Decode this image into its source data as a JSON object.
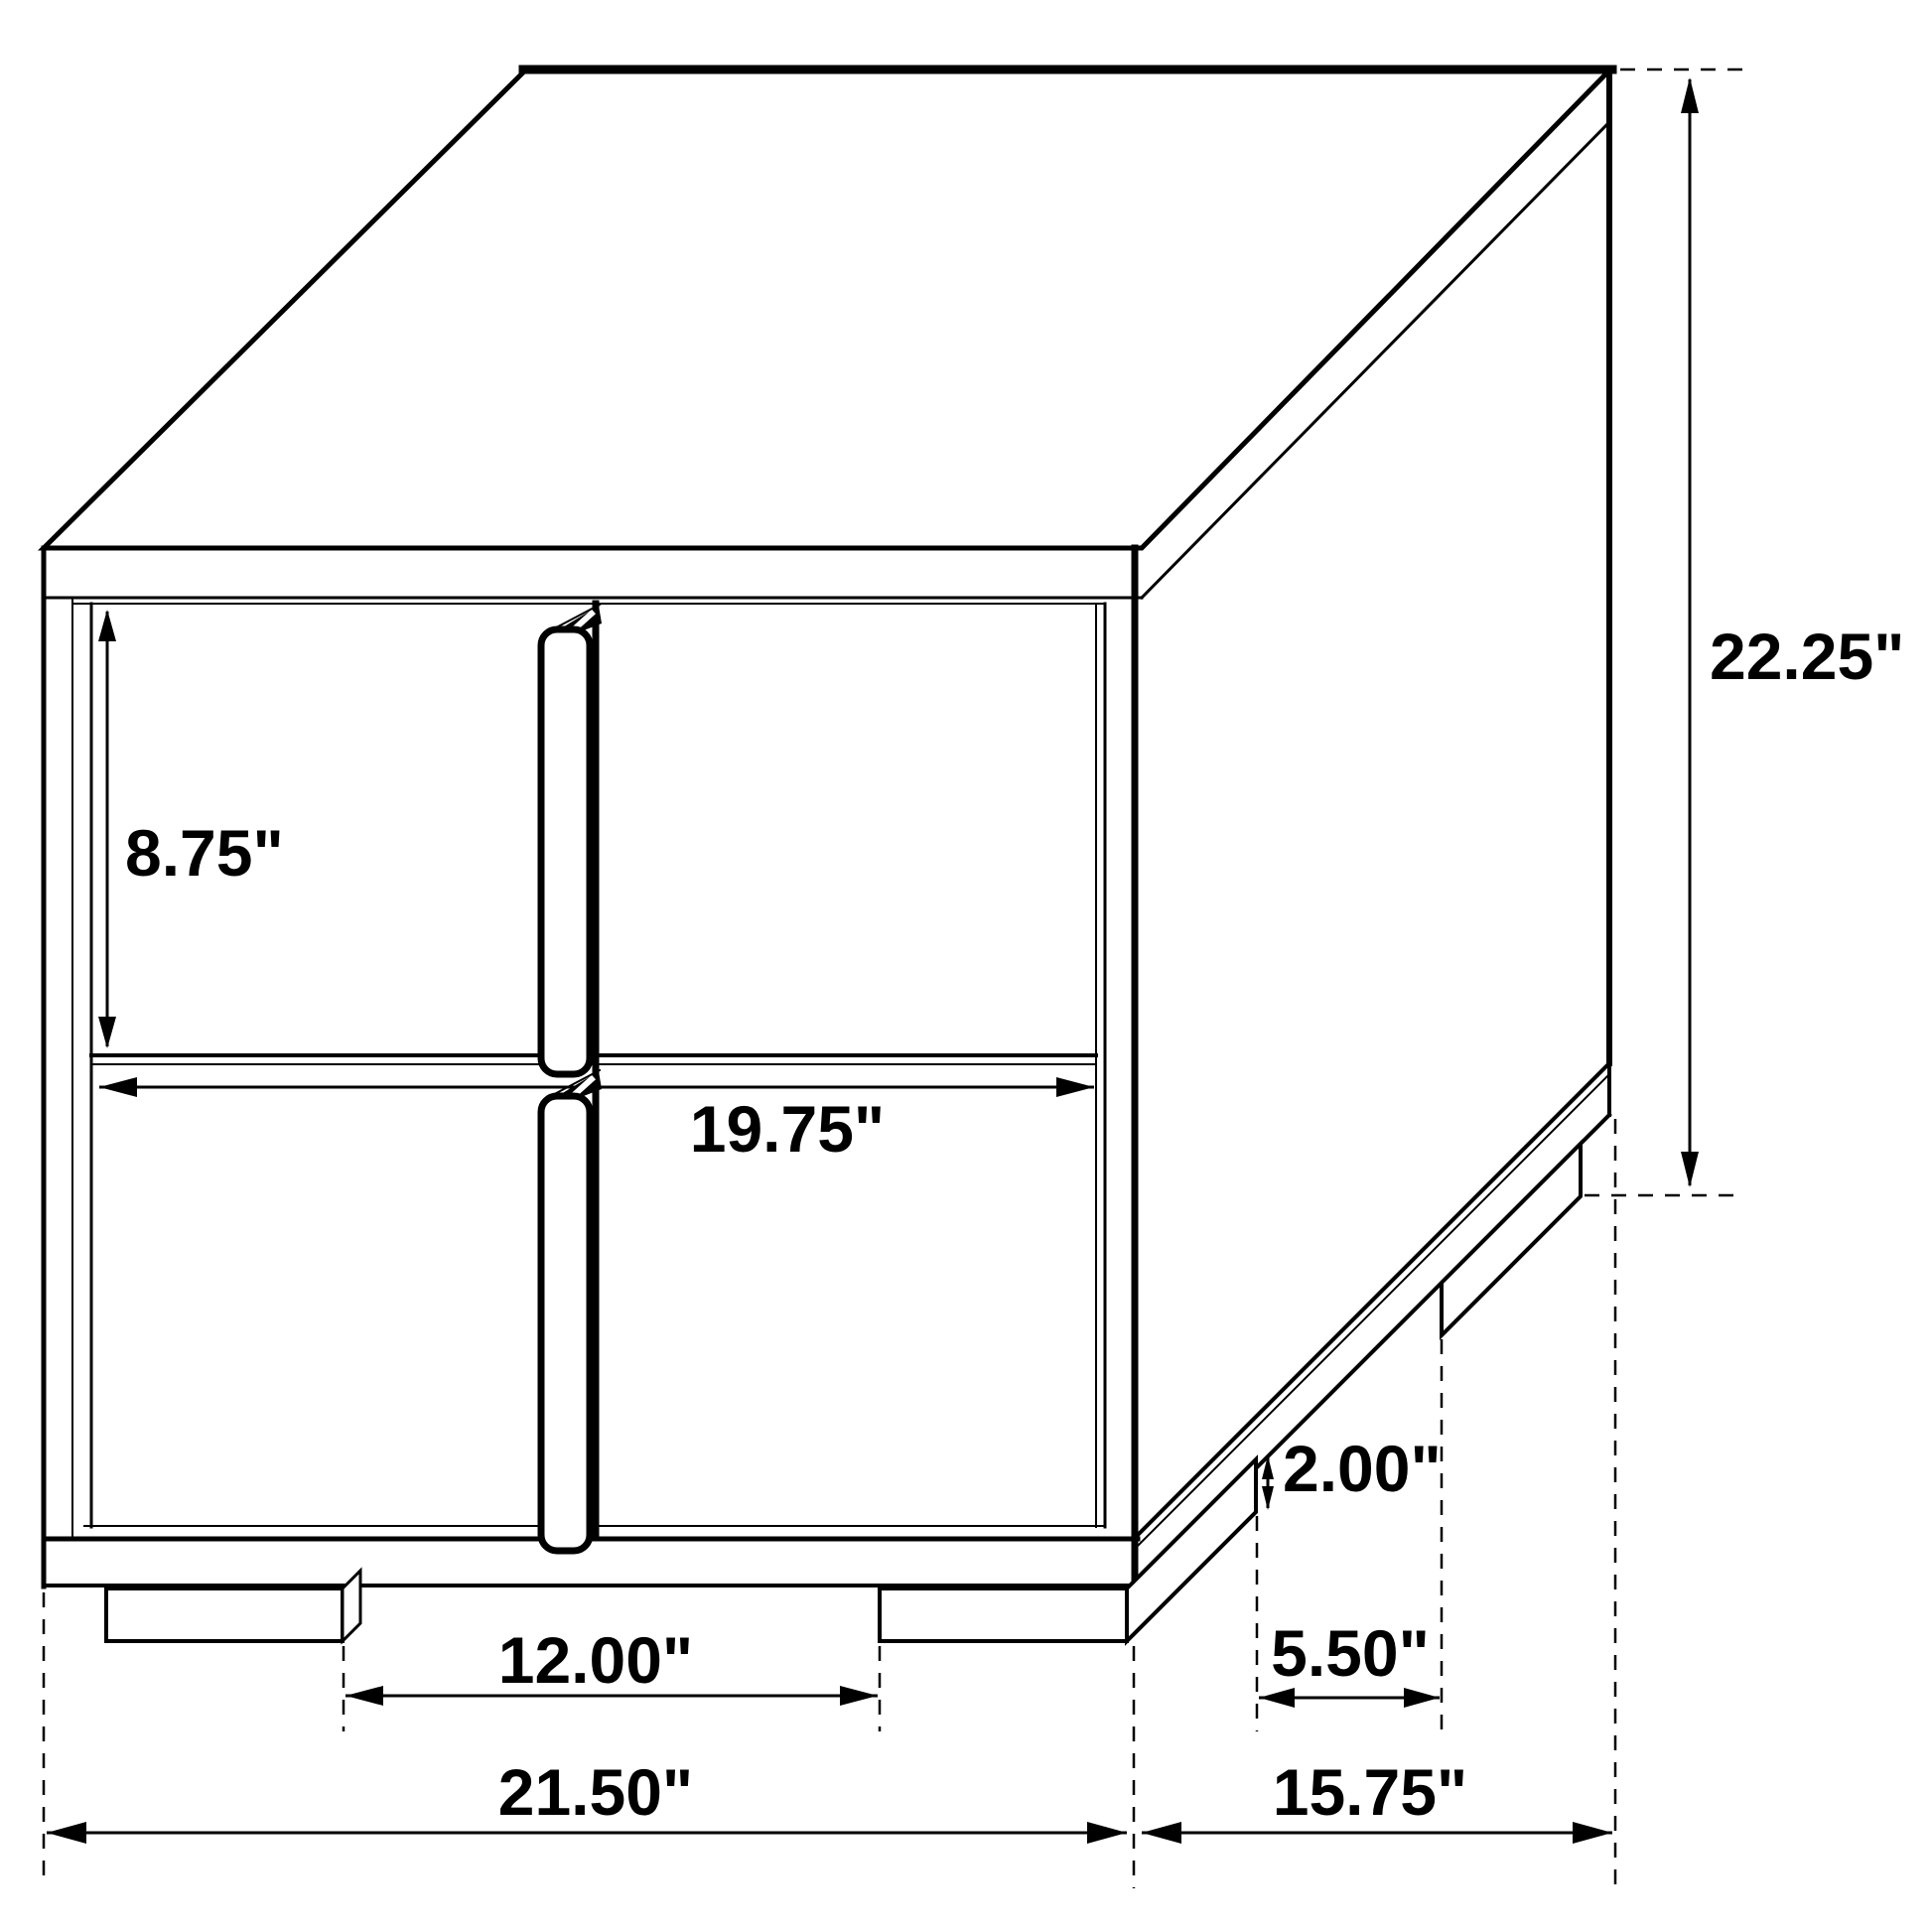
{
  "drawing": {
    "colors": {
      "line": "#000000",
      "background": "#ffffff"
    },
    "dimensions": {
      "upper_drawer_height": "8.75\"",
      "drawer_width": "19.75\"",
      "overall_height": "22.25\"",
      "leg_height": "2.00\"",
      "side_leg_spacing": "5.50\"",
      "front_leg_spacing": "12.00\"",
      "overall_width": "21.50\"",
      "overall_depth": "15.75\""
    }
  }
}
